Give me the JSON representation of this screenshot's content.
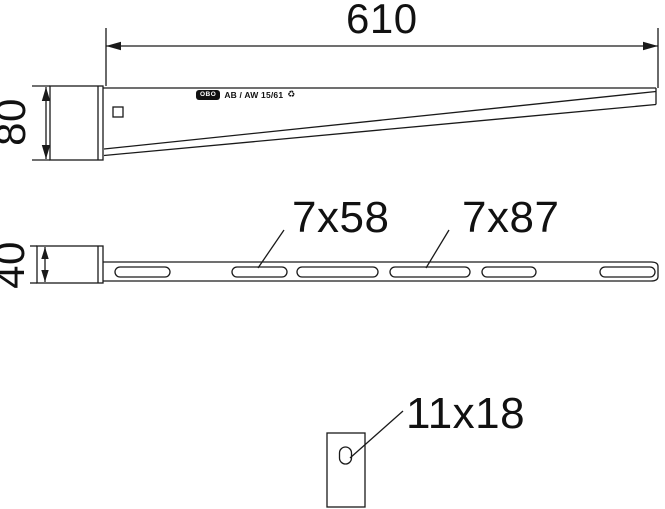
{
  "drawing": {
    "colors": {
      "line": "#1a1a1a",
      "background": "#ffffff",
      "text": "#111111"
    },
    "views": {
      "side": {
        "length_dim": "610",
        "height_dim": "80",
        "brand_logo": "OBO",
        "marking": "AB / AW 15/61",
        "marking_symbol": "♻"
      },
      "plan": {
        "depth_dim": "40",
        "slot_label_small": "7x58",
        "slot_label_large": "7x87"
      },
      "detail": {
        "hole_label": "11x18"
      }
    }
  }
}
